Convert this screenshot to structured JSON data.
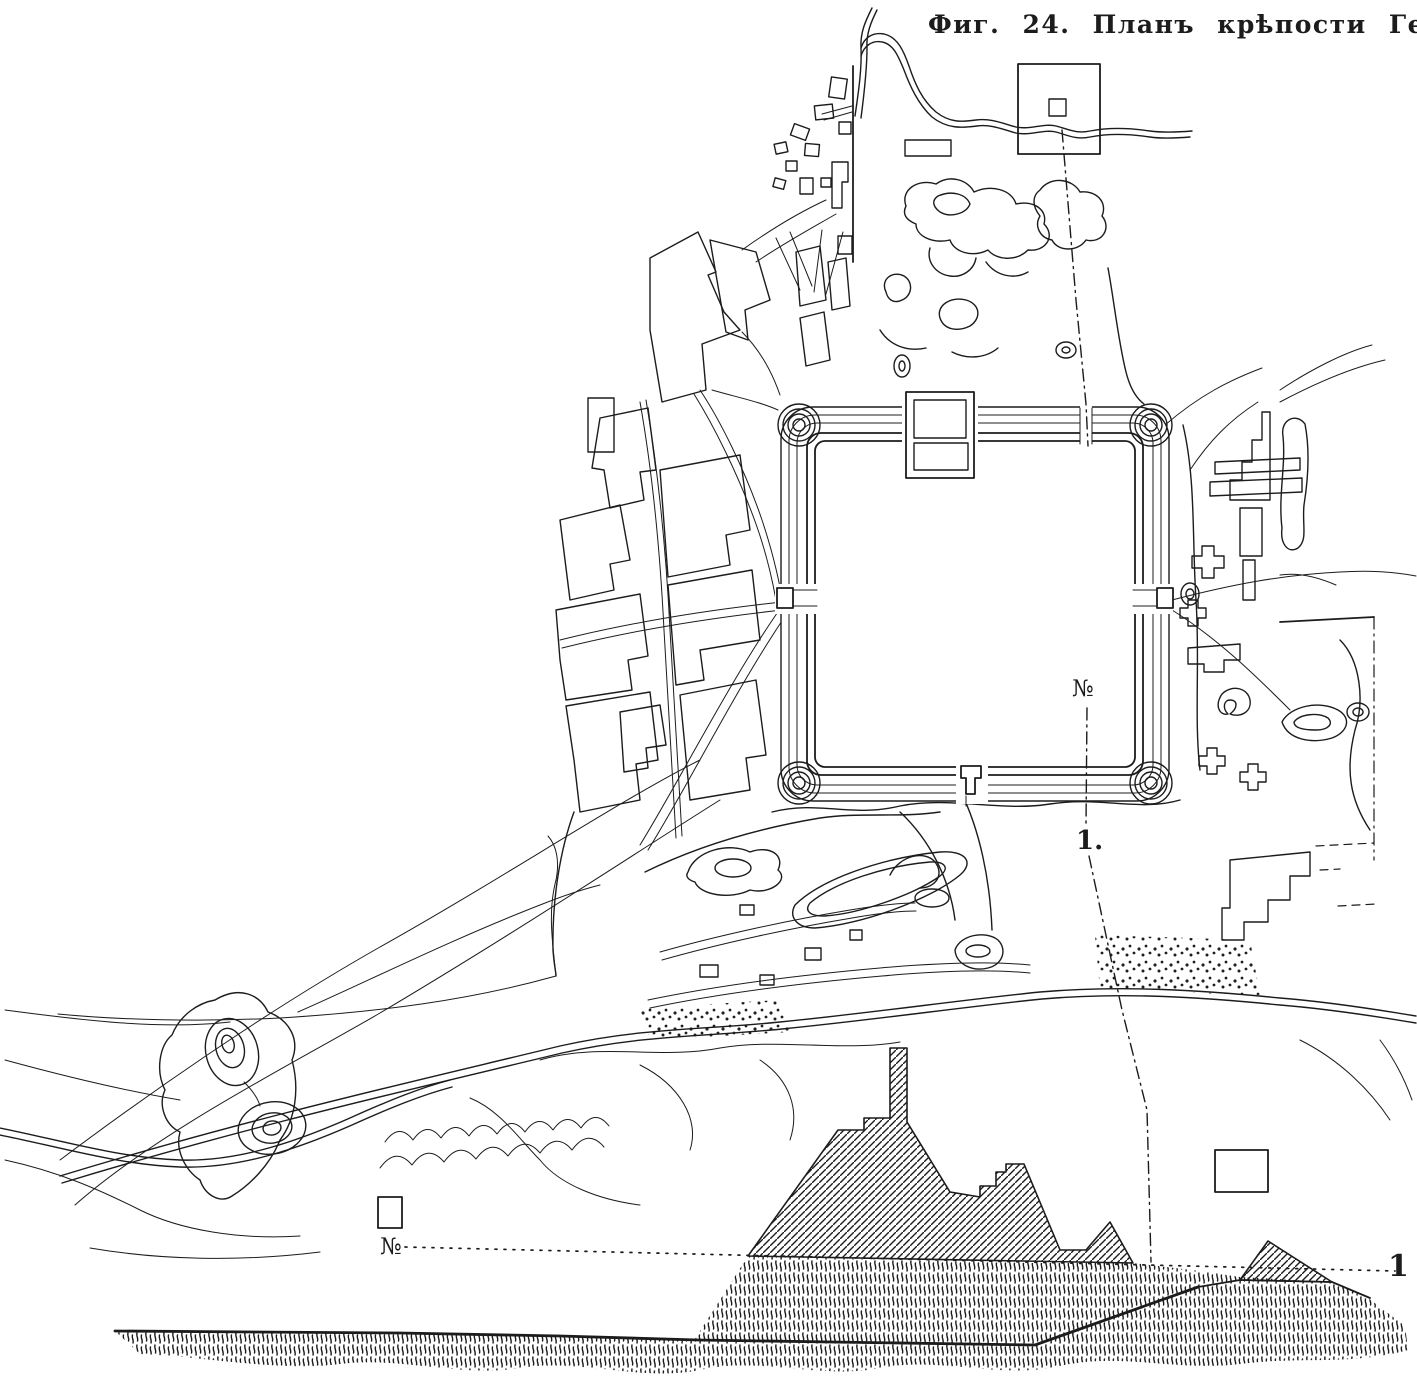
{
  "figure": {
    "caption": "Фиг. 24. Планъ крѣпости Гератъ.",
    "plan": {
      "section_line_start_label": "№",
      "section_line_end_label": "1."
    },
    "profile": {
      "baseline_start_label": "№",
      "baseline_end_label": "1"
    },
    "colors": {
      "ink": "#1c1c1c",
      "paper": "#ffffff"
    }
  }
}
